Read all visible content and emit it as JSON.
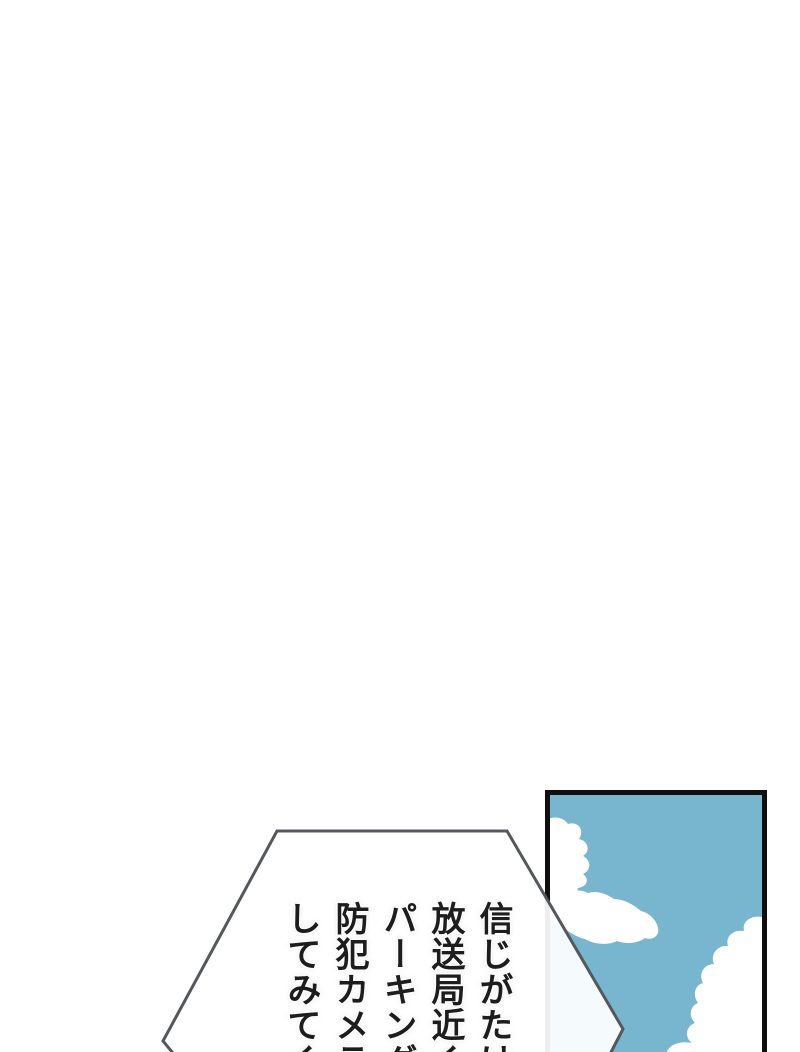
{
  "page": {
    "background_color": "#ffffff"
  },
  "speech_bubble": {
    "text": "信じがたけ\n放送局近く\nパーキング\n防犯カメラ\nしてみてく",
    "text_columns": [
      "信じがたけ",
      "放送局近く",
      "パーキング",
      "防犯カメラ",
      "してみてく"
    ],
    "outline_color": "#54585c",
    "fill_color": "rgba(255,255,255,0.93)"
  },
  "panel": {
    "sky_color": "#78b5ce",
    "cloud_color": "#ffffff",
    "border_color": "#0f0f0f"
  }
}
